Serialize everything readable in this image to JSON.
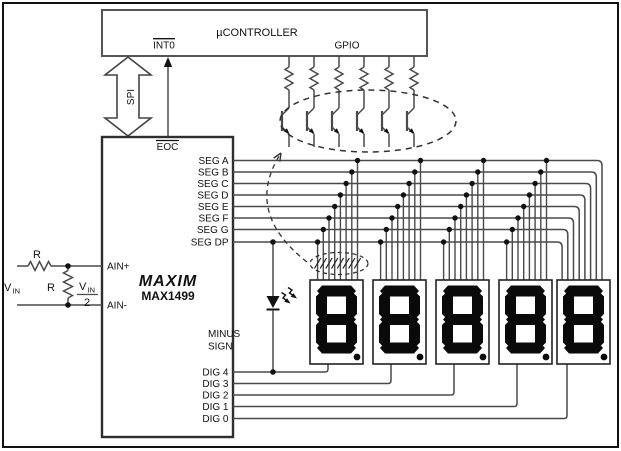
{
  "controller": {
    "title": "µCONTROLLER",
    "pin_int0": "INT0",
    "pin_gpio": "GPIO"
  },
  "links": {
    "spi_label": "SPI",
    "eoc_label": "EOC"
  },
  "adc": {
    "brand": "MAXIM",
    "part": "MAX1499",
    "pin_ain_plus": "AIN+",
    "pin_ain_minus": "AIN-",
    "seg_pins": [
      "SEG A",
      "SEG B",
      "SEG C",
      "SEG D",
      "SEG E",
      "SEG F",
      "SEG G",
      "SEG DP"
    ],
    "dig_pins": [
      "DIG 4",
      "DIG 3",
      "DIG 2",
      "DIG 1",
      "DIG 0"
    ]
  },
  "input_network": {
    "vin": {
      "base": "V",
      "sub": "IN"
    },
    "series_resistor": "R",
    "shunt_resistor": "R",
    "divider": {
      "num_base": "V",
      "num_sub": "IN",
      "den": "2"
    }
  },
  "led": {
    "line1": "MINUS",
    "line2": "SIGN"
  },
  "displays": {
    "count": 5,
    "digits": [
      "8",
      "8",
      "8",
      "8",
      "8"
    ],
    "decimal_point": true
  },
  "drivers": {
    "transistor_count": 6
  },
  "colors": {
    "wire": "#4a4a4a",
    "ink": "#111111",
    "box_stroke": "#3c3c3c",
    "background": "#ffffff"
  }
}
